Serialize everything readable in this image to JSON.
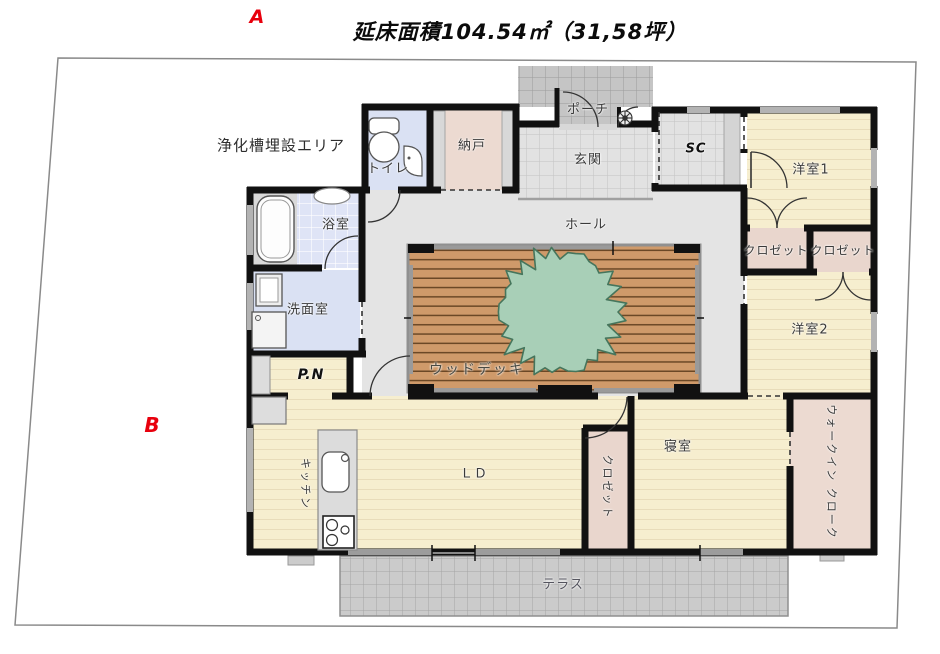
{
  "title": {
    "text": "延床面積104.54㎡（31,58坪）"
  },
  "markers": {
    "a": "A",
    "b": "B"
  },
  "site": {
    "septic_label": "浄化槽埋設エリア"
  },
  "rooms": {
    "porch": "ポーチ",
    "entrance": "玄関",
    "toilet": "トイレ",
    "storage": "納戸",
    "shoe_closet": "SC",
    "bedroom1": "洋室1",
    "closet_a": "クロゼット",
    "closet_b": "クロゼット",
    "bedroom2": "洋室2",
    "bathroom": "浴室",
    "washroom": "洗面室",
    "hall": "ホール",
    "wood_deck": "ウッドデッキ",
    "pantry": "P.N",
    "kitchen": "キッチン",
    "living_dining": "ＬＤ",
    "closet_c": "クロゼット",
    "master_bedroom": "寝室",
    "walk_in_closet": "ウォークイン クローク",
    "terrace": "テラス"
  },
  "colors": {
    "wall": "#111111",
    "floor_cream": "#f6eecf",
    "floor_cream_stripe": "#e8dcba",
    "floor_pink": "#ecdad1",
    "floor_blue": "#dae1f3",
    "bath_tile": "#dfe4f6",
    "hall_gray": "#e4e4e4",
    "entrance_tile": "#e2e2e2",
    "porch_tile": "#c5c5c5",
    "terrace_tile": "#cbcbcb",
    "deck_wood": "#cf9a6a",
    "deck_line": "#6b4826",
    "tree_green": "#a8cfb7",
    "tree_edge": "#46755c",
    "boundary": "#8a8a8a",
    "marker_red": "#e8000d"
  }
}
